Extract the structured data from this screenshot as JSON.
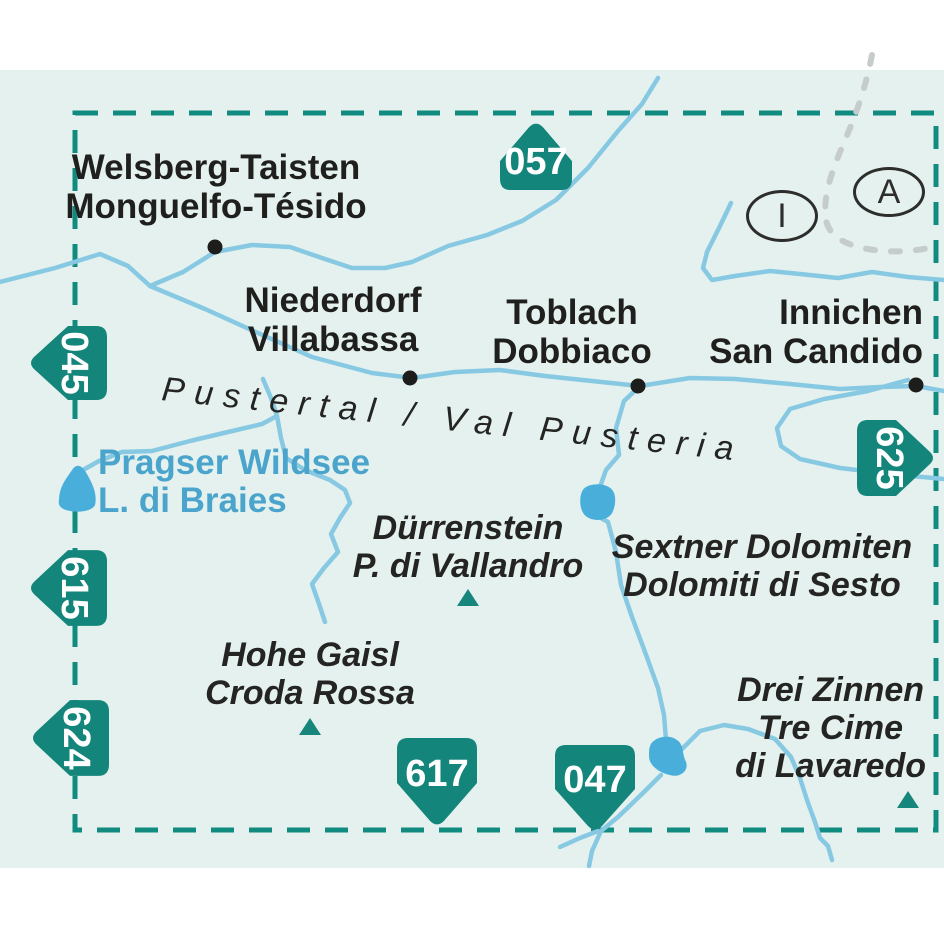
{
  "map": {
    "colors": {
      "background": "#e4f1ee",
      "frame_teal": "#118a80",
      "badge_teal": "#13857b",
      "river_blue": "#87c9e2",
      "lake_blue": "#49afda",
      "lake_label_blue": "#4aa4cc",
      "text_black": "#1f1f1d",
      "country_border_gray": "#c6cccb"
    },
    "towns": [
      {
        "name_line1": "Welsberg-Taisten",
        "name_line2": "Monguelfo-Tésido"
      },
      {
        "name_line1": "Niederdorf",
        "name_line2": "Villabassa"
      },
      {
        "name_line1": "Toblach",
        "name_line2": "Dobbiaco"
      },
      {
        "name_line1": "Innichen",
        "name_line2": "San Candido"
      }
    ],
    "peaks": [
      {
        "line1": "Dürrenstein",
        "line2": "P. di Vallandro"
      },
      {
        "line1": "Hohe Gaisl",
        "line2": "Croda Rossa"
      },
      {
        "line1": "Drei Zinnen",
        "line2": "Tre Cime",
        "line3": "di Lavaredo"
      }
    ],
    "ranges": [
      {
        "line1": "Sextner Dolomiten",
        "line2": "Dolomiti di Sesto"
      }
    ],
    "lake_label": {
      "line1": "Pragser Wildsee",
      "line2": "L. di Braies"
    },
    "valley_label": "Pustertal / Val Pusteria",
    "sheets": [
      {
        "number": "057",
        "edge": "top"
      },
      {
        "number": "045",
        "edge": "left"
      },
      {
        "number": "615",
        "edge": "left"
      },
      {
        "number": "624",
        "edge": "left"
      },
      {
        "number": "625",
        "edge": "right"
      },
      {
        "number": "617",
        "edge": "bottom"
      },
      {
        "number": "047",
        "edge": "bottom"
      }
    ],
    "country_markers": [
      {
        "label": "I"
      },
      {
        "label": "A"
      }
    ]
  }
}
